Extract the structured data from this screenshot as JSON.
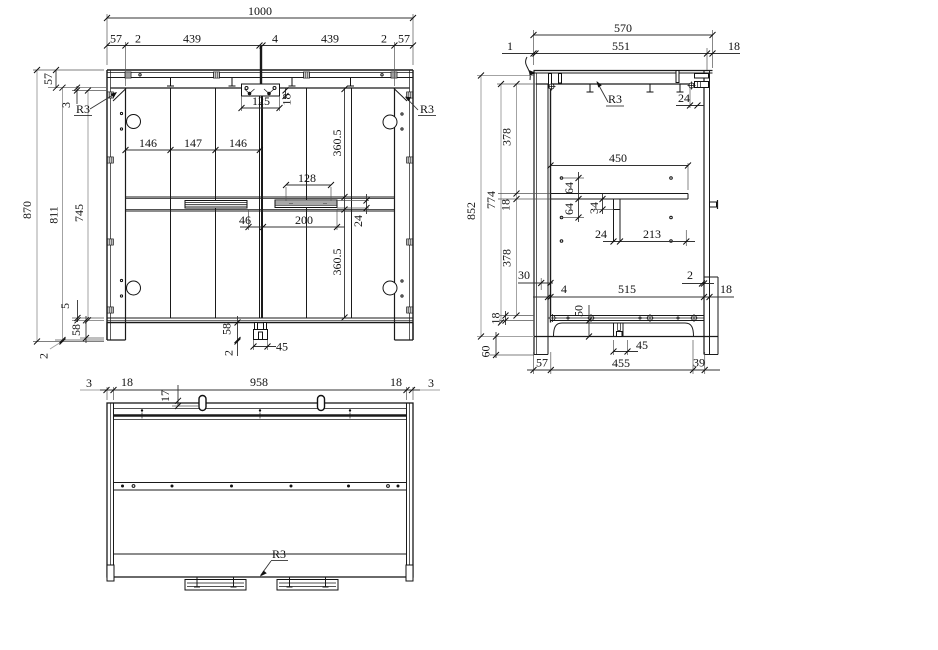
{
  "colors": {
    "line": "#1a1a1a",
    "dimension": "#333333",
    "dimension_light": "#a3a3a3",
    "background": "#ffffff"
  },
  "labels": {
    "front": {
      "w_total": "1000",
      "chain_top": [
        "57",
        "2",
        "439",
        "4",
        "439",
        "2",
        "57"
      ],
      "h870": "870",
      "h811": "811",
      "h745": "745",
      "t57": "57",
      "t3": "3",
      "r3_left": "R3",
      "b5": "5",
      "b58": "58",
      "b2": "2",
      "d125": "125",
      "d18": "18",
      "d146a": "146",
      "d147": "147",
      "d146b": "146",
      "d128": "128",
      "d360a": "360.5",
      "d360b": "360.5",
      "d24": "24",
      "d46": "46",
      "d200": "200",
      "bc58": "58",
      "bc2": "2",
      "bc45": "45",
      "r3_right": "R3"
    },
    "side": {
      "w570": "570",
      "w551": "551",
      "w1": "1",
      "w18": "18",
      "r3": "R3",
      "t24": "24",
      "h852": "852",
      "h774": "774",
      "h378a": "378",
      "h18a": "18",
      "h378b": "378",
      "d30": "30",
      "d450": "450",
      "d64a": "64",
      "d64b": "64",
      "d34": "34",
      "d24": "24",
      "d213": "213",
      "d2": "2",
      "d4": "4",
      "d515": "515",
      "d18r": "18",
      "d50": "50",
      "d45": "45",
      "h60": "60",
      "h18b": "18",
      "c57": "57",
      "c455": "455",
      "c39": "39"
    },
    "plan": {
      "c3l": "3",
      "c18l": "18",
      "c958": "958",
      "c18r": "18",
      "c3r": "3",
      "d17": "17",
      "r3": "R3"
    }
  }
}
